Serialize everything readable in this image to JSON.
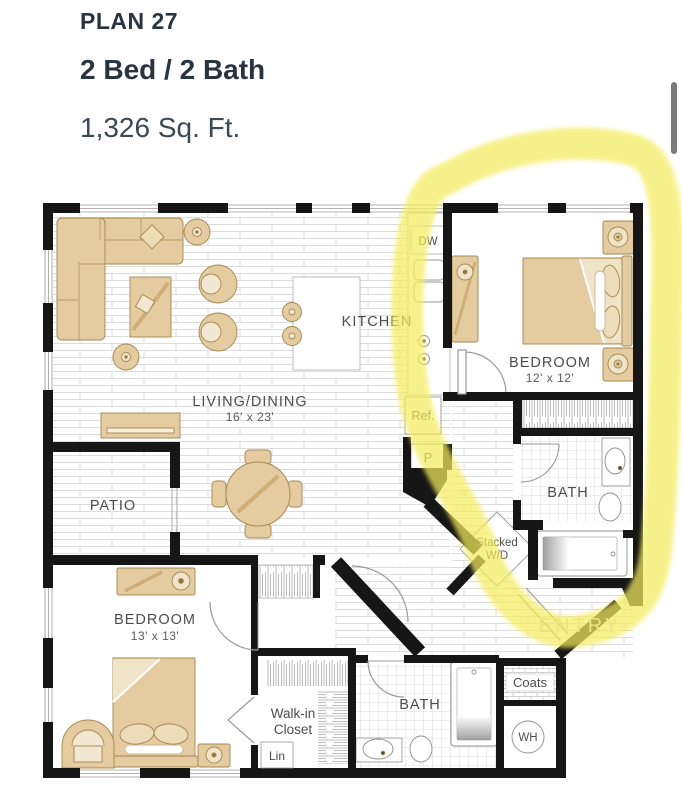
{
  "header": {
    "plan_name": "PLAN 27",
    "beds_baths": "2 Bed / 2 Bath",
    "area": "1,326 Sq. Ft."
  },
  "floorplan": {
    "rooms": {
      "living_dining": {
        "label": "LIVING/DINING",
        "dims": "16' x 23'"
      },
      "kitchen": {
        "label": "KITCHEN"
      },
      "patio": {
        "label": "PATIO"
      },
      "bedroom_left": {
        "label": "BEDROOM",
        "dims": "13' x 13'"
      },
      "bedroom_right": {
        "label": "BEDROOM",
        "dims": "12' x 12'"
      },
      "bath_right": {
        "label": "BATH"
      },
      "bath_bottom": {
        "label": "BATH"
      },
      "walk_in_closet": {
        "line1": "Walk-in",
        "line2": "Closet"
      },
      "entry": {
        "label": "ENTRY"
      }
    },
    "fixtures": {
      "dishwasher": "DW",
      "refrigerator": "Ref.",
      "pantry": "P",
      "stacked_wd_line1": "Stacked",
      "stacked_wd_line2": "W/D",
      "coats": "Coats",
      "water_heater": "WH",
      "linen": "Lin"
    }
  },
  "colors": {
    "heading": "#2a3440",
    "subtext": "#3c4854",
    "wall": "#161616",
    "label": "#4d4d4d",
    "furniture": "#e4cba0",
    "furniture_outline": "#a3874f",
    "floor_line": "#dcdcdc",
    "highlight": "#f5ec5f",
    "entry_label": "#d4d4d4",
    "scrollbar": "#7b7b7b"
  }
}
